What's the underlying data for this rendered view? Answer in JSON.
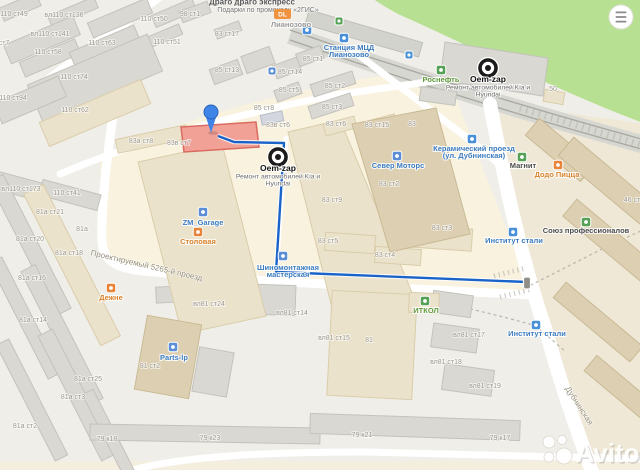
{
  "map": {
    "watermark": "Avito",
    "ad": {
      "line1": "Драго драго экспресс",
      "line2": "Подарки по промокоду «2ГИС»",
      "badge": "DL"
    },
    "menu": {
      "icon": "hamburger-menu-icon"
    },
    "colors": {
      "route": "#1a63c8",
      "selected_building": "#f2a196",
      "selected_building_stroke": "#d96b61",
      "pin": "#3f85e8"
    },
    "pin": {
      "x": 211,
      "y": 112
    },
    "route": {
      "points": "218,136 234,142 284,143 276,272 527,282",
      "end": {
        "x": 527,
        "y": 283
      }
    },
    "markers": [
      {
        "id": "oem-zap-marker-main",
        "x": 278,
        "y": 157,
        "title": "Oem-zap",
        "sub1": "Ремонт автомобилей Kia и",
        "sub2": "Hyundai"
      },
      {
        "id": "oem-zap-marker-branch",
        "x": 488,
        "y": 68,
        "title": "Oem-zap",
        "sub1": "Ремонт автомобилей Kia и",
        "sub2": "Hyundai"
      }
    ],
    "pois": [
      {
        "id": "stantsiya-mcd",
        "lines": [
          "Станция МЦД",
          "Лианозово"
        ],
        "x": 349,
        "y": 50,
        "c": "blue",
        "icon": {
          "n": "train-station-icon",
          "x": 344,
          "y": 38,
          "f": "#4a90d9"
        }
      },
      {
        "id": "lianozovo",
        "lines": [
          "Лианозово"
        ],
        "x": 291,
        "y": 27,
        "c": "gray",
        "icon": {
          "n": "suburban-train-icon",
          "x": 307,
          "y": 30,
          "f": "#4a90d9"
        }
      },
      {
        "id": "rosneft",
        "lines": [
          "Роснефть"
        ],
        "x": 441,
        "y": 82,
        "c": "green",
        "icon": {
          "n": "fuel-station-icon",
          "x": 441,
          "y": 70,
          "f": "#56a156"
        }
      },
      {
        "id": "sever-motors",
        "lines": [
          "Север Моторс"
        ],
        "x": 398,
        "y": 168,
        "c": "blue",
        "icon": {
          "n": "car-dealer-icon",
          "x": 397,
          "y": 156,
          "f": "#5b8ed6"
        }
      },
      {
        "id": "keramichesky-proezd",
        "lines": [
          "Керамический проезд",
          "(ул. Дубнинская)"
        ],
        "x": 474,
        "y": 151,
        "c": "blue",
        "icon": {
          "n": "bus-stop-icon",
          "x": 472,
          "y": 139,
          "f": "#4a90d9"
        }
      },
      {
        "id": "magnit",
        "lines": [
          "Магнит"
        ],
        "x": 523,
        "y": 168,
        "c": "dark",
        "icon": {
          "n": "grocery-icon",
          "x": 522,
          "y": 157,
          "f": "#56a156"
        }
      },
      {
        "id": "dodo-pizza",
        "lines": [
          "Додо Пицца"
        ],
        "x": 557,
        "y": 177,
        "c": "orange",
        "icon": {
          "n": "pizza-icon",
          "x": 558,
          "y": 165,
          "f": "#e8853a"
        }
      },
      {
        "id": "soyuz-professionalov",
        "lines": [
          "Союз профессионалов"
        ],
        "x": 586,
        "y": 233,
        "c": "dark",
        "icon": {
          "n": "organization-icon",
          "x": 586,
          "y": 222,
          "f": "#56a156"
        }
      },
      {
        "id": "institut-stali-1",
        "lines": [
          "Институт стали"
        ],
        "x": 514,
        "y": 243,
        "c": "blue",
        "icon": {
          "n": "bus-stop-icon",
          "x": 513,
          "y": 232,
          "f": "#4a90d9"
        }
      },
      {
        "id": "institut-stali-2",
        "lines": [
          "Институт стали"
        ],
        "x": 537,
        "y": 336,
        "c": "blue",
        "icon": {
          "n": "bus-stop-icon",
          "x": 536,
          "y": 325,
          "f": "#4a90d9"
        }
      },
      {
        "id": "itkol",
        "lines": [
          "ИТКОЛ"
        ],
        "x": 426,
        "y": 313,
        "c": "green",
        "icon": {
          "n": "office-icon",
          "x": 425,
          "y": 301,
          "f": "#56a156"
        }
      },
      {
        "id": "zm-garage",
        "lines": [
          "ZM_Garage"
        ],
        "x": 203,
        "y": 225,
        "c": "blue",
        "icon": {
          "n": "car-service-icon",
          "x": 203,
          "y": 212,
          "f": "#5b8ed6"
        }
      },
      {
        "id": "stolovaya",
        "lines": [
          "Столовая"
        ],
        "x": 198,
        "y": 244,
        "c": "orange",
        "icon": {
          "n": "cafe-icon",
          "x": 198,
          "y": 232,
          "f": "#e8853a"
        }
      },
      {
        "id": "shinomontazh",
        "lines": [
          "Шиномонтажная",
          "мастерская"
        ],
        "x": 288,
        "y": 270,
        "c": "blue",
        "icon": {
          "n": "tire-service-icon",
          "x": 283,
          "y": 256,
          "f": "#5b8ed6"
        }
      },
      {
        "id": "dezhne",
        "lines": [
          "Дежне"
        ],
        "x": 111,
        "y": 300,
        "c": "orange",
        "icon": {
          "n": "cafe-icon",
          "x": 111,
          "y": 288,
          "f": "#e8853a"
        }
      },
      {
        "id": "parts-lp",
        "lines": [
          "Parts-lp"
        ],
        "x": 174,
        "y": 360,
        "c": "blue",
        "icon": {
          "n": "auto-parts-icon",
          "x": 173,
          "y": 347,
          "f": "#5b8ed6"
        }
      }
    ],
    "transport_icons": [
      {
        "n": "bus-stop-icon",
        "x": 409,
        "y": 55,
        "f": "#4a90d9"
      },
      {
        "n": "station-entrance-icon",
        "x": 339,
        "y": 21,
        "f": "#56a156"
      },
      {
        "n": "info-icon",
        "x": 272,
        "y": 71,
        "f": "#5b8ed6"
      }
    ],
    "streets": [
      {
        "t": "Проектируемый 5265-й проезд",
        "x": 146,
        "y": 268,
        "r": 13
      },
      {
        "t": "Дубнинская",
        "x": 577,
        "y": 407,
        "r": 57
      }
    ],
    "buildings": [
      {
        "t": "110 ст49",
        "x": 14,
        "y": 16
      },
      {
        "t": "вл110 ст136",
        "x": 64,
        "y": 17
      },
      {
        "t": "110 ст50",
        "x": 154,
        "y": 21
      },
      {
        "t": "98 ст1",
        "x": 190,
        "y": 16
      },
      {
        "t": "вл110 ст141",
        "x": 50,
        "y": 36
      },
      {
        "t": "110 ст63",
        "x": 102,
        "y": 45
      },
      {
        "t": "110 ст51",
        "x": 167,
        "y": 44
      },
      {
        "t": "83 ст17",
        "x": 227,
        "y": 36
      },
      {
        "t": "110 ст58",
        "x": 48,
        "y": 54
      },
      {
        "t": "85 ст13",
        "x": 227,
        "y": 72
      },
      {
        "t": "85 ст14",
        "x": 290,
        "y": 74
      },
      {
        "t": "85 ст1",
        "x": 313,
        "y": 61
      },
      {
        "t": "110 ст74",
        "x": 74,
        "y": 79
      },
      {
        "t": "85 ст5",
        "x": 289,
        "y": 92
      },
      {
        "t": "85 ст2",
        "x": 335,
        "y": 88
      },
      {
        "t": "50",
        "x": 553,
        "y": 91
      },
      {
        "t": "110 ст94",
        "x": 13,
        "y": 100
      },
      {
        "t": "85 ст3",
        "x": 332,
        "y": 109
      },
      {
        "t": "85 ст8",
        "x": 264,
        "y": 110
      },
      {
        "t": "110 ст62",
        "x": 75,
        "y": 112
      },
      {
        "t": "ст7",
        "x": 4,
        "y": 45
      },
      {
        "t": "83 ст6",
        "x": 336,
        "y": 126
      },
      {
        "t": "83 ст15",
        "x": 377,
        "y": 127
      },
      {
        "t": "83",
        "x": 412,
        "y": 126
      },
      {
        "t": "83в ст6",
        "x": 278,
        "y": 127
      },
      {
        "t": "83а ст8",
        "x": 141,
        "y": 143
      },
      {
        "t": "83в ст7",
        "x": 179,
        "y": 145
      },
      {
        "t": "83 ст2",
        "x": 389,
        "y": 186
      },
      {
        "t": "вл110 ст173",
        "x": 21,
        "y": 191
      },
      {
        "t": "110 ст41",
        "x": 67,
        "y": 195
      },
      {
        "t": "83 ст9",
        "x": 332,
        "y": 202
      },
      {
        "t": "46 ст1",
        "x": 634,
        "y": 202
      },
      {
        "t": "81а ст21",
        "x": 50,
        "y": 214
      },
      {
        "t": "81а",
        "x": 82,
        "y": 231
      },
      {
        "t": "81а ст20",
        "x": 30,
        "y": 241
      },
      {
        "t": "83 ст5",
        "x": 328,
        "y": 243
      },
      {
        "t": "83 ст3",
        "x": 442,
        "y": 230
      },
      {
        "t": "81а ст18",
        "x": 69,
        "y": 255
      },
      {
        "t": "83 ст4",
        "x": 385,
        "y": 257
      },
      {
        "t": "81а ст16",
        "x": 32,
        "y": 280
      },
      {
        "t": "вл81 ст24",
        "x": 209,
        "y": 306
      },
      {
        "t": "вл81 ст14",
        "x": 292,
        "y": 315
      },
      {
        "t": "81а ст14",
        "x": 33,
        "y": 322
      },
      {
        "t": "вл81 ст15",
        "x": 334,
        "y": 340
      },
      {
        "t": "81",
        "x": 369,
        "y": 342
      },
      {
        "t": "вл81 ст17",
        "x": 469,
        "y": 337
      },
      {
        "t": "вл81 ст18",
        "x": 446,
        "y": 364
      },
      {
        "t": "81 ст2",
        "x": 150,
        "y": 368
      },
      {
        "t": "81а ст25",
        "x": 88,
        "y": 381
      },
      {
        "t": "вл81 ст19",
        "x": 485,
        "y": 388
      },
      {
        "t": "81а ст3",
        "x": 73,
        "y": 399
      },
      {
        "t": "81а ст2",
        "x": 25,
        "y": 428
      },
      {
        "t": "79 к18",
        "x": 107,
        "y": 441
      },
      {
        "t": "79 к23",
        "x": 210,
        "y": 440
      },
      {
        "t": "79 к21",
        "x": 362,
        "y": 437
      },
      {
        "t": "79 к17",
        "x": 500,
        "y": 440
      }
    ]
  }
}
